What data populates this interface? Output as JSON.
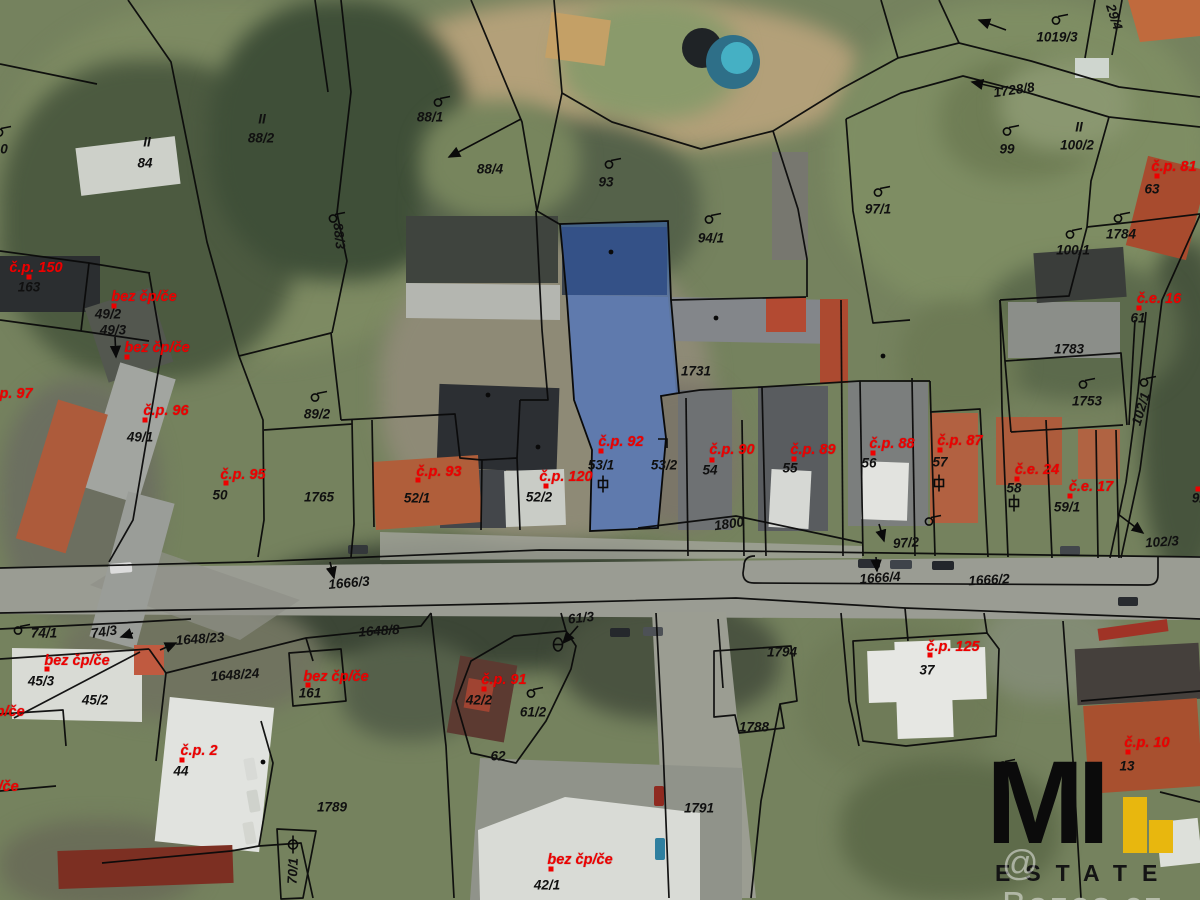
{
  "map": {
    "highlight_color": "#2f62c4",
    "parcel_number_color": "#101010",
    "building_number_color": "#ee0000",
    "labels": [
      {
        "text": "84",
        "x": 145,
        "y": 163,
        "color": "black"
      },
      {
        "text": "II",
        "x": 147,
        "y": 142,
        "color": "black"
      },
      {
        "text": "88/2",
        "x": 261,
        "y": 138,
        "color": "black"
      },
      {
        "text": "II",
        "x": 262,
        "y": 119,
        "color": "black"
      },
      {
        "text": "88/1",
        "x": 430,
        "y": 117,
        "color": "black"
      },
      {
        "text": "88/4",
        "x": 490,
        "y": 169,
        "color": "black"
      },
      {
        "text": "88/3",
        "x": 339,
        "y": 236,
        "color": "black",
        "rot": 84
      },
      {
        "text": "93",
        "x": 606,
        "y": 182,
        "color": "black"
      },
      {
        "text": "94/1",
        "x": 711,
        "y": 238,
        "color": "black"
      },
      {
        "text": "1019/3",
        "x": 1057,
        "y": 37,
        "color": "black"
      },
      {
        "text": "1728/8",
        "x": 1014,
        "y": 90,
        "color": "black",
        "rot": -8
      },
      {
        "text": "29/4",
        "x": 1114,
        "y": 17,
        "color": "black",
        "rot": 72
      },
      {
        "text": "99",
        "x": 1007,
        "y": 149,
        "color": "black"
      },
      {
        "text": "100/2",
        "x": 1077,
        "y": 145,
        "color": "black"
      },
      {
        "text": "II",
        "x": 1079,
        "y": 127,
        "color": "black"
      },
      {
        "text": "63",
        "x": 1152,
        "y": 189,
        "color": "black"
      },
      {
        "text": "97/1",
        "x": 878,
        "y": 209,
        "color": "black"
      },
      {
        "text": "1784",
        "x": 1121,
        "y": 234,
        "color": "black"
      },
      {
        "text": "100/1",
        "x": 1073,
        "y": 250,
        "color": "black"
      },
      {
        "text": "163",
        "x": 29,
        "y": 287,
        "color": "black"
      },
      {
        "text": "49/2",
        "x": 108,
        "y": 314,
        "color": "black"
      },
      {
        "text": "49/3",
        "x": 113,
        "y": 330,
        "color": "black"
      },
      {
        "text": "49/1",
        "x": 140,
        "y": 437,
        "color": "black"
      },
      {
        "text": "89/2",
        "x": 317,
        "y": 414,
        "color": "black"
      },
      {
        "text": "50",
        "x": 220,
        "y": 495,
        "color": "black"
      },
      {
        "text": "1765",
        "x": 319,
        "y": 497,
        "color": "black"
      },
      {
        "text": "52/1",
        "x": 417,
        "y": 498,
        "color": "black"
      },
      {
        "text": "52/2",
        "x": 539,
        "y": 497,
        "color": "black"
      },
      {
        "text": "53/1",
        "x": 601,
        "y": 465,
        "color": "black"
      },
      {
        "text": "53/2",
        "x": 664,
        "y": 465,
        "color": "black"
      },
      {
        "text": "54",
        "x": 710,
        "y": 470,
        "color": "black"
      },
      {
        "text": "55",
        "x": 790,
        "y": 468,
        "color": "black"
      },
      {
        "text": "56",
        "x": 869,
        "y": 463,
        "color": "black"
      },
      {
        "text": "57",
        "x": 940,
        "y": 462,
        "color": "black"
      },
      {
        "text": "58",
        "x": 1014,
        "y": 488,
        "color": "black"
      },
      {
        "text": "59/1",
        "x": 1067,
        "y": 507,
        "color": "black"
      },
      {
        "text": "1800",
        "x": 729,
        "y": 524,
        "color": "black",
        "rot": -8
      },
      {
        "text": "97/2",
        "x": 906,
        "y": 543,
        "color": "black",
        "rot": -4
      },
      {
        "text": "1731",
        "x": 696,
        "y": 371,
        "color": "black"
      },
      {
        "text": "1783",
        "x": 1069,
        "y": 349,
        "color": "black"
      },
      {
        "text": "1753",
        "x": 1087,
        "y": 401,
        "color": "black"
      },
      {
        "text": "102/1",
        "x": 1141,
        "y": 409,
        "color": "black",
        "rot": -73
      },
      {
        "text": "102/3",
        "x": 1162,
        "y": 542,
        "color": "black",
        "rot": -4
      },
      {
        "text": "92/1",
        "x": 1205,
        "y": 498,
        "color": "black",
        "dot": [
          1198,
          489
        ]
      },
      {
        "text": "61",
        "x": 1138,
        "y": 318,
        "color": "black"
      },
      {
        "text": "1666/3",
        "x": 349,
        "y": 583,
        "color": "black",
        "rot": -5
      },
      {
        "text": "1648/8",
        "x": 379,
        "y": 631,
        "color": "black",
        "rot": -4
      },
      {
        "text": "61/3",
        "x": 581,
        "y": 618,
        "color": "black",
        "rot": -6
      },
      {
        "text": "1666/4",
        "x": 880,
        "y": 578,
        "color": "black",
        "rot": -4
      },
      {
        "text": "1666/2",
        "x": 989,
        "y": 580,
        "color": "black",
        "rot": -3
      },
      {
        "text": "74/1",
        "x": 44,
        "y": 633,
        "color": "black"
      },
      {
        "text": "74/3",
        "x": 104,
        "y": 632,
        "color": "black",
        "rot": -8
      },
      {
        "text": "1648/23",
        "x": 200,
        "y": 639,
        "color": "black",
        "rot": -4
      },
      {
        "text": "45/3",
        "x": 41,
        "y": 681,
        "color": "black"
      },
      {
        "text": "45/2",
        "x": 95,
        "y": 700,
        "color": "black"
      },
      {
        "text": "1648/24",
        "x": 235,
        "y": 675,
        "color": "black",
        "rot": -4
      },
      {
        "text": "161",
        "x": 310,
        "y": 693,
        "color": "black"
      },
      {
        "text": "44",
        "x": 181,
        "y": 771,
        "color": "black"
      },
      {
        "text": "1789",
        "x": 332,
        "y": 807,
        "color": "black"
      },
      {
        "text": "70/1",
        "x": 293,
        "y": 871,
        "color": "black",
        "rot": -87
      },
      {
        "text": "1794",
        "x": 782,
        "y": 652,
        "color": "black"
      },
      {
        "text": "1788",
        "x": 754,
        "y": 727,
        "color": "black"
      },
      {
        "text": "1791",
        "x": 699,
        "y": 808,
        "color": "black"
      },
      {
        "text": "42/2",
        "x": 479,
        "y": 700,
        "color": "black"
      },
      {
        "text": "61/2",
        "x": 533,
        "y": 712,
        "color": "black"
      },
      {
        "text": "62",
        "x": 498,
        "y": 756,
        "color": "black"
      },
      {
        "text": "42/1",
        "x": 547,
        "y": 885,
        "color": "black"
      },
      {
        "text": "37",
        "x": 927,
        "y": 670,
        "color": "black"
      },
      {
        "text": "13",
        "x": 1127,
        "y": 766,
        "color": "black"
      },
      {
        "text": "0",
        "x": 4,
        "y": 149,
        "color": "black"
      },
      {
        "text": "č.p. 150",
        "x": 36,
        "y": 268,
        "color": "red",
        "dot": [
          29,
          277
        ]
      },
      {
        "text": "bez čp/če",
        "x": 144,
        "y": 297,
        "color": "red",
        "dot": [
          114,
          306
        ]
      },
      {
        "text": "bez čp/če",
        "x": 157,
        "y": 348,
        "color": "red",
        "dot": [
          127,
          357
        ]
      },
      {
        "text": "č.p. 97",
        "x": 10,
        "y": 394,
        "color": "red"
      },
      {
        "text": "č.p. 96",
        "x": 166,
        "y": 411,
        "color": "red",
        "dot": [
          145,
          420
        ]
      },
      {
        "text": "č.p. 95",
        "x": 243,
        "y": 475,
        "color": "red",
        "dot": [
          226,
          483
        ]
      },
      {
        "text": "č.p. 93",
        "x": 439,
        "y": 472,
        "color": "red",
        "dot": [
          418,
          480
        ]
      },
      {
        "text": "č.p. 120",
        "x": 566,
        "y": 477,
        "color": "red",
        "dot": [
          546,
          486
        ]
      },
      {
        "text": "č.p. 92",
        "x": 621,
        "y": 442,
        "color": "red",
        "dot": [
          601,
          451
        ]
      },
      {
        "text": "č.p. 90",
        "x": 732,
        "y": 450,
        "color": "red",
        "dot": [
          712,
          460
        ]
      },
      {
        "text": "č.p. 89",
        "x": 813,
        "y": 450,
        "color": "red",
        "dot": [
          794,
          459
        ]
      },
      {
        "text": "č.p. 88",
        "x": 892,
        "y": 444,
        "color": "red",
        "dot": [
          873,
          453
        ]
      },
      {
        "text": "č.p. 87",
        "x": 960,
        "y": 441,
        "color": "red",
        "dot": [
          940,
          450
        ]
      },
      {
        "text": "č.e. 24",
        "x": 1037,
        "y": 470,
        "color": "red",
        "dot": [
          1017,
          479
        ]
      },
      {
        "text": "č.e. 17",
        "x": 1091,
        "y": 487,
        "color": "red",
        "dot": [
          1070,
          496
        ]
      },
      {
        "text": "č.e. 16",
        "x": 1159,
        "y": 299,
        "color": "red",
        "dot": [
          1139,
          308
        ]
      },
      {
        "text": "č.p. 81",
        "x": 1174,
        "y": 167,
        "color": "red",
        "dot": [
          1157,
          176
        ]
      },
      {
        "text": "bez čp/če",
        "x": 77,
        "y": 661,
        "color": "red",
        "dot": [
          47,
          669
        ]
      },
      {
        "text": "bez čp/če",
        "x": -8,
        "y": 712,
        "color": "red"
      },
      {
        "text": "bez čp/če",
        "x": -14,
        "y": 787,
        "color": "red"
      },
      {
        "text": "bez čp/če",
        "x": 336,
        "y": 677,
        "color": "red",
        "dot": [
          308,
          685
        ]
      },
      {
        "text": "č.p. 2",
        "x": 199,
        "y": 751,
        "color": "red",
        "dot": [
          182,
          760
        ]
      },
      {
        "text": "č.p. 91",
        "x": 504,
        "y": 680,
        "color": "red",
        "dot": [
          484,
          689
        ]
      },
      {
        "text": "bez čp/če",
        "x": 580,
        "y": 860,
        "color": "red",
        "dot": [
          551,
          869
        ]
      },
      {
        "text": "č.p. 125",
        "x": 953,
        "y": 647,
        "color": "red",
        "dot": [
          930,
          655
        ]
      },
      {
        "text": "č.p. 10",
        "x": 1147,
        "y": 743,
        "color": "red",
        "dot": [
          1128,
          752
        ]
      }
    ],
    "symbols": [
      {
        "kind": "flag",
        "x": 3,
        "y": 133
      },
      {
        "kind": "flag",
        "x": 337,
        "y": 219
      },
      {
        "kind": "flag",
        "x": 442,
        "y": 103
      },
      {
        "kind": "flag",
        "x": 613,
        "y": 165
      },
      {
        "kind": "flag",
        "x": 713,
        "y": 220
      },
      {
        "kind": "flag",
        "x": 1060,
        "y": 21
      },
      {
        "kind": "flag",
        "x": 1011,
        "y": 132
      },
      {
        "kind": "flag",
        "x": 882,
        "y": 193
      },
      {
        "kind": "flag",
        "x": 1122,
        "y": 219
      },
      {
        "kind": "flag",
        "x": 1074,
        "y": 235
      },
      {
        "kind": "flag",
        "x": 1087,
        "y": 385
      },
      {
        "kind": "flag",
        "x": 1148,
        "y": 383
      },
      {
        "kind": "flag",
        "x": 319,
        "y": 398
      },
      {
        "kind": "flag",
        "x": 535,
        "y": 694
      },
      {
        "kind": "flag",
        "x": 22,
        "y": 631
      },
      {
        "kind": "flag",
        "x": 1007,
        "y": 766
      },
      {
        "kind": "flag",
        "x": 933,
        "y": 522
      },
      {
        "kind": "gate",
        "x": 603,
        "y": 487
      },
      {
        "kind": "gate",
        "x": 939,
        "y": 486
      },
      {
        "kind": "gate",
        "x": 1014,
        "y": 506
      },
      {
        "kind": "theta",
        "x": 558,
        "y": 647
      },
      {
        "kind": "phi",
        "x": 293,
        "y": 847
      },
      {
        "kind": "corner",
        "x": 663,
        "y": 446
      }
    ],
    "arrows": [
      [
        521,
        119,
        449,
        157
      ],
      [
        1003,
        89,
        972,
        82
      ],
      [
        1006,
        30,
        979,
        20
      ],
      [
        330,
        562,
        334,
        578
      ],
      [
        578,
        626,
        563,
        643
      ],
      [
        879,
        524,
        884,
        541
      ],
      [
        876,
        557,
        877,
        571
      ],
      [
        1118,
        514,
        1143,
        533
      ],
      [
        133,
        633,
        121,
        637
      ],
      [
        160,
        650,
        176,
        643
      ],
      [
        115,
        337,
        116,
        357
      ]
    ]
  },
  "logo": {
    "mi": "MI",
    "estate": "ESTATE",
    "watermark": "@ Bazos.cz",
    "accent": "#e8b70e"
  }
}
